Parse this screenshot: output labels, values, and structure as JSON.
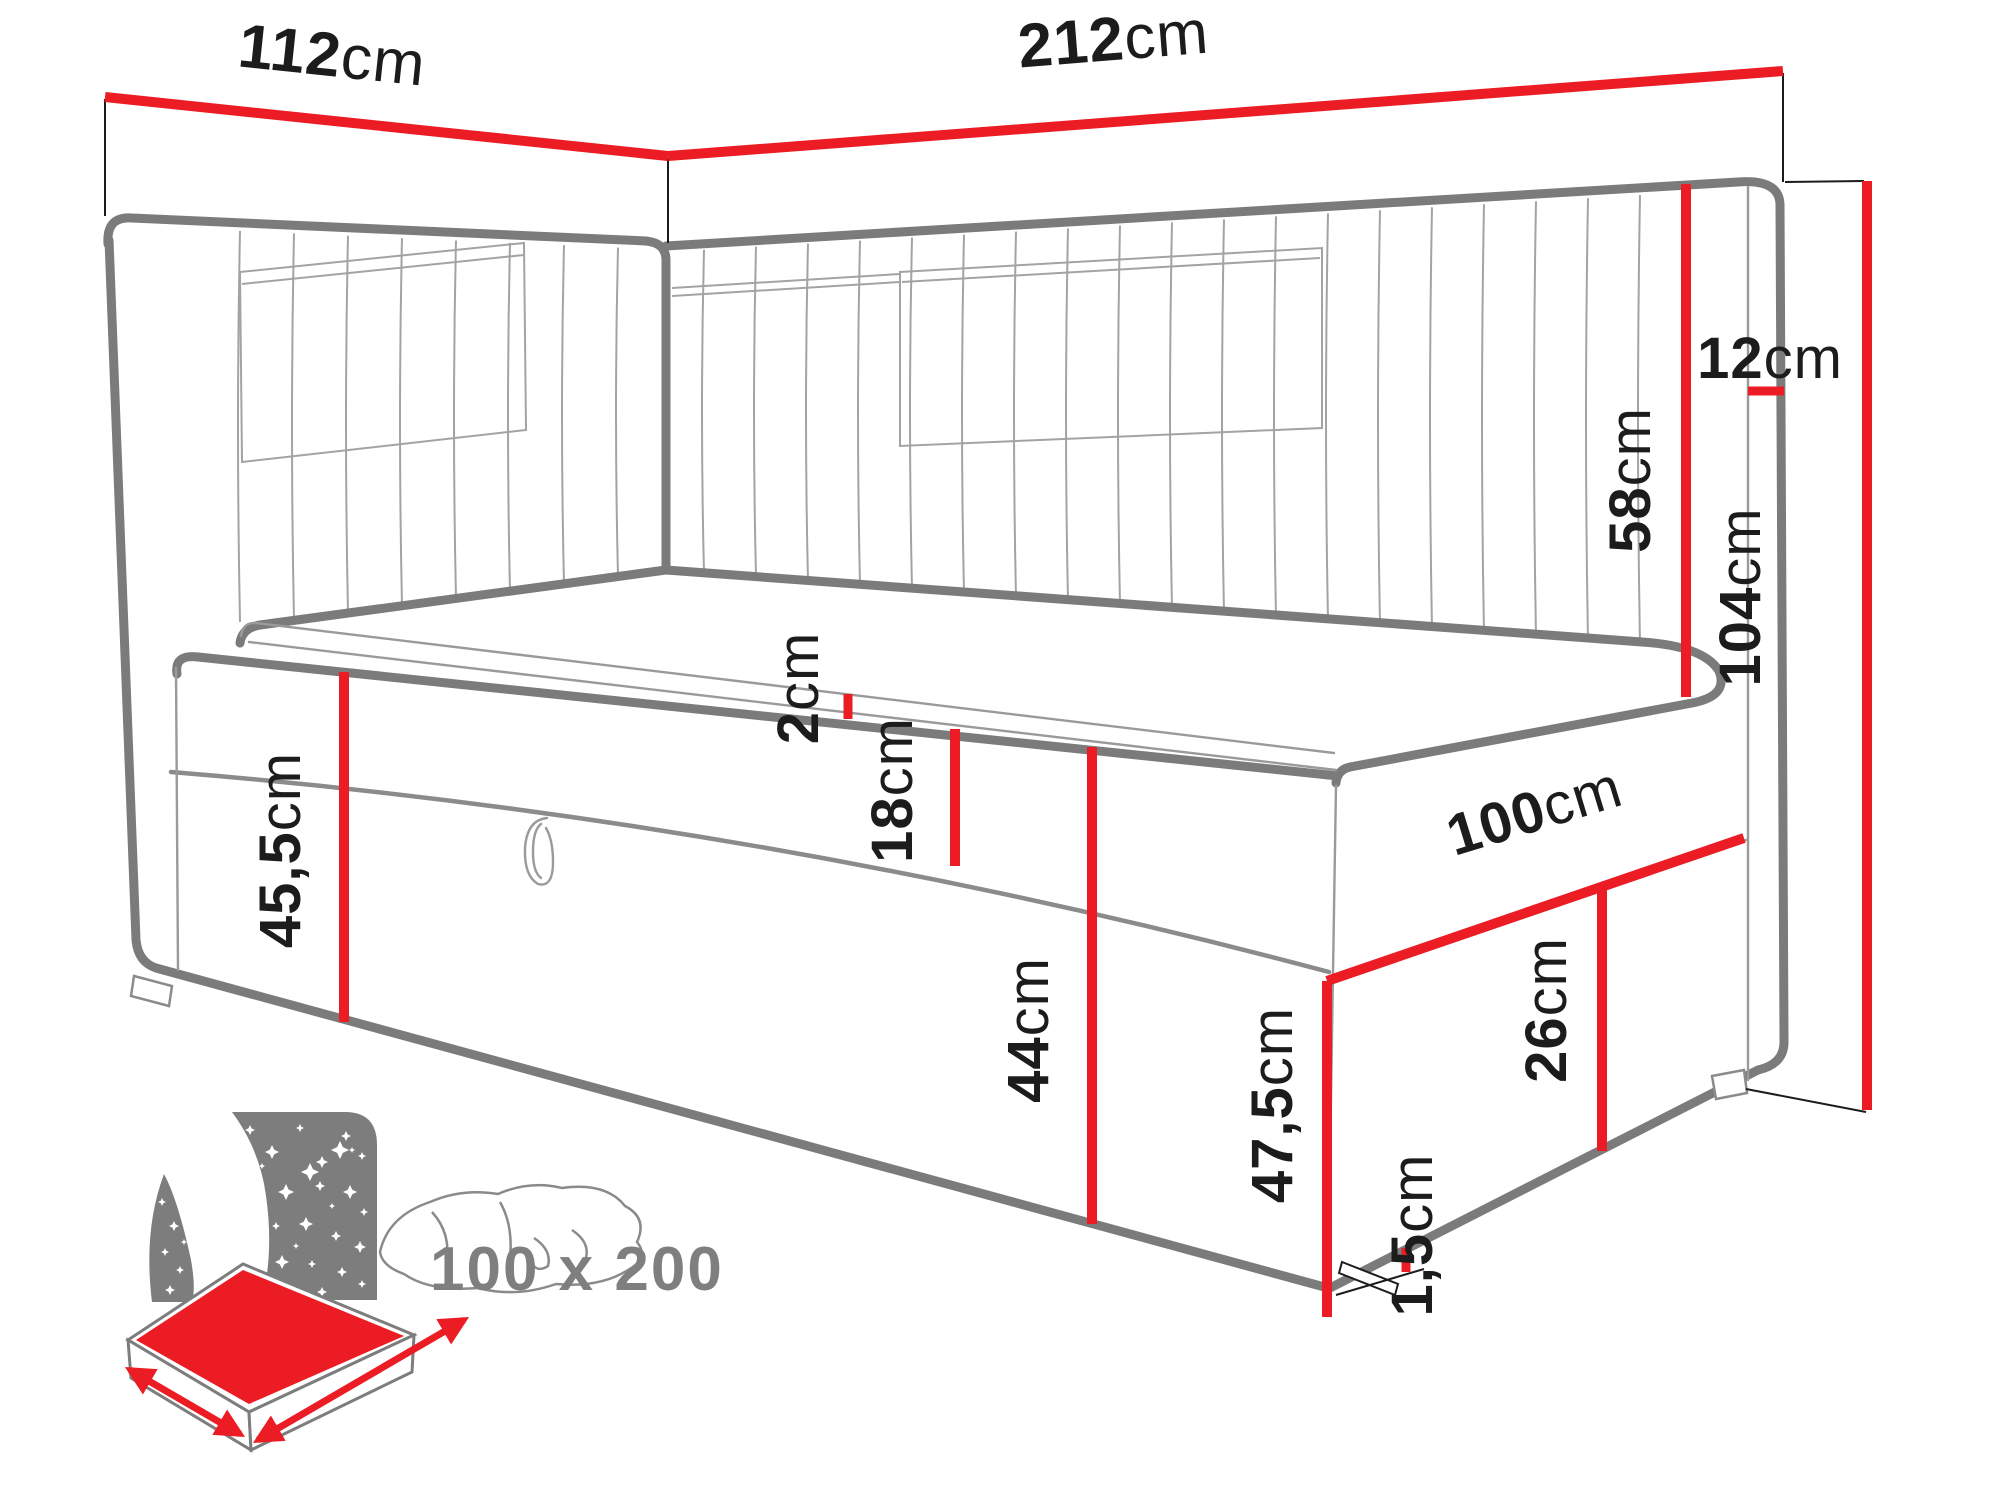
{
  "diagram": {
    "title_hidden": "",
    "subject": "corner-daybed-dimension-diagram",
    "palette": {
      "dimension_red": "#ec1c24",
      "bed_gray": "#7b7b7b",
      "label_black": "#1c1c1c",
      "icon_gray": "#7d7d7d"
    },
    "dimensions": {
      "head_side_width": {
        "num": "112",
        "unit": "cm"
      },
      "total_length": {
        "num": "212",
        "unit": "cm"
      },
      "headboard_thickness": {
        "num": "12",
        "unit": "cm"
      },
      "headboard_above_seat": {
        "num": "58",
        "unit": "cm"
      },
      "total_height": {
        "num": "104",
        "unit": "cm"
      },
      "topper_height": {
        "num": "2",
        "unit": "cm"
      },
      "mattress_height": {
        "num": "18",
        "unit": "cm"
      },
      "base_height_front": {
        "num": "44",
        "unit": "cm"
      },
      "base_height_head": {
        "num": "45,5",
        "unit": "cm"
      },
      "foot_width": {
        "num": "100",
        "unit": "cm"
      },
      "foot_panel_height": {
        "num": "26",
        "unit": "cm"
      },
      "seat_height": {
        "num": "47,5",
        "unit": "cm"
      },
      "glide_height": {
        "num": "1,5",
        "unit": "cm"
      }
    },
    "icon": {
      "size_label": "100 x 200"
    }
  }
}
